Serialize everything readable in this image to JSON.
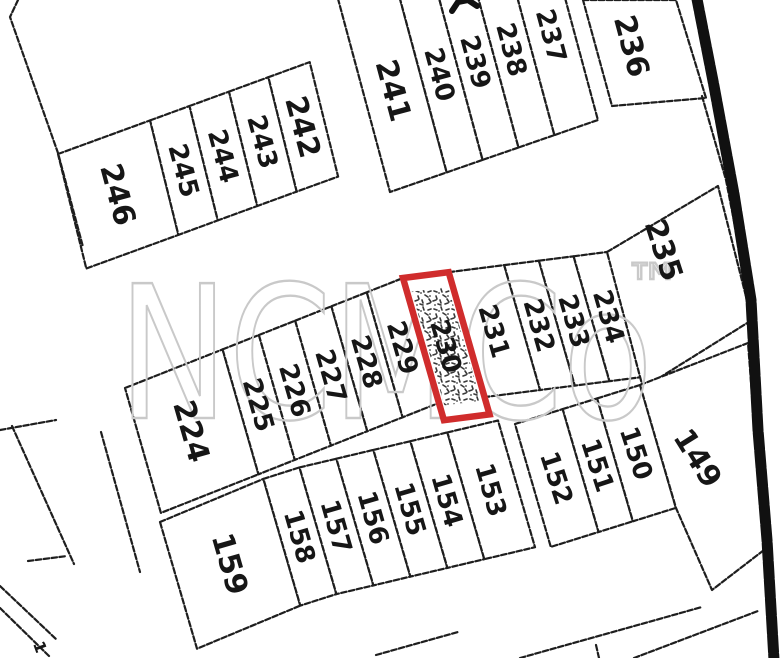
{
  "map": {
    "background": "#ffffff",
    "line_color": "#1e1e1e",
    "highlight_color": "#d02c2c",
    "stipple_color": "#3a3a3a",
    "watermark": {
      "text": "NCMCo",
      "tm": "™",
      "color": "#c9c9c9",
      "x": 118,
      "y": 418,
      "size": 185,
      "textLength": 535,
      "tmX": 624,
      "tmY": 305,
      "tmSize": 58
    },
    "rows": [
      {
        "name": "block-246-242",
        "baseline": "top",
        "polyline": [
          [
            58,
            154
          ],
          [
            310,
            62
          ]
        ],
        "lean": [
          0.24,
          0.97
        ],
        "depth": 118,
        "textAngle": 75,
        "lots": [
          {
            "label": "246",
            "w": 98,
            "big": true
          },
          {
            "label": "245",
            "w": 42
          },
          {
            "label": "244",
            "w": 42
          },
          {
            "label": "243",
            "w": 42
          },
          {
            "label": "242",
            "w": 44,
            "big": true
          }
        ]
      },
      {
        "name": "block-241-237",
        "baseline": "bottom",
        "polyline": [
          [
            390,
            192
          ],
          [
            598,
            120
          ]
        ],
        "lean": [
          0.26,
          0.966
        ],
        "depth": 230,
        "labelOffset": -95,
        "textAngle": 75,
        "lots": [
          {
            "label": "241",
            "w": 60,
            "big": true
          },
          {
            "label": "240",
            "w": 38
          },
          {
            "label": "239",
            "w": 38
          },
          {
            "label": "238",
            "w": 38
          },
          {
            "label": "237",
            "w": 46
          }
        ]
      },
      {
        "name": "block-224-234",
        "baseline": "top",
        "polyline": [
          [
            125,
            388
          ],
          [
            403,
            278
          ],
          [
            607,
            252
          ]
        ],
        "lean": [
          0.276,
          0.961
        ],
        "depth": 130,
        "textAngle": 74,
        "lots": [
          {
            "label": "224",
            "w": 105,
            "big": true
          },
          {
            "label": "225",
            "w": 39
          },
          {
            "label": "226",
            "w": 39
          },
          {
            "label": "227",
            "w": 39
          },
          {
            "label": "228",
            "w": 38
          },
          {
            "label": "229",
            "w": 39
          },
          {
            "label": "230",
            "w": 46,
            "d": 148,
            "highlight": true
          },
          {
            "label": "231",
            "w": 56
          },
          {
            "label": "232",
            "w": 35
          },
          {
            "label": "233",
            "w": 35
          },
          {
            "label": "234",
            "w": 35
          }
        ]
      },
      {
        "name": "block-159-153",
        "baseline": "top",
        "polyline": [
          [
            160,
            522
          ],
          [
            280,
            472
          ],
          [
            500,
            420
          ]
        ],
        "lean": [
          0.28,
          0.96
        ],
        "depth": 132,
        "textAngle": 74,
        "lots": [
          {
            "label": "159",
            "w": 112,
            "big": true
          },
          {
            "label": "158",
            "w": 38
          },
          {
            "label": "157",
            "w": 38
          },
          {
            "label": "156",
            "w": 38
          },
          {
            "label": "155",
            "w": 38
          },
          {
            "label": "154",
            "w": 38
          },
          {
            "label": "153",
            "w": 52
          }
        ]
      },
      {
        "name": "block-152-150",
        "baseline": "top",
        "polyline": [
          [
            515,
            424
          ],
          [
            640,
            385
          ]
        ],
        "lean": [
          0.28,
          0.96
        ],
        "depth": 128,
        "textAngle": 72,
        "lots": [
          {
            "label": "152",
            "w": 50
          },
          {
            "label": "151",
            "w": 36
          },
          {
            "label": "150",
            "w": 45
          }
        ]
      }
    ],
    "explicit_lots": [
      {
        "label": "236",
        "quad": [
          [
            583,
            0
          ],
          [
            676,
            0
          ],
          [
            706,
            98
          ],
          [
            612,
            106
          ]
        ],
        "labelPos": [
          632,
          46
        ],
        "angle": 75,
        "big": true
      },
      {
        "label": "235",
        "quad": [
          [
            607,
            252
          ],
          [
            718,
            186
          ],
          [
            752,
            320
          ],
          [
            643,
            388
          ]
        ],
        "labelPos": [
          664,
          250
        ],
        "angle": 72,
        "big": true
      },
      {
        "label": "149",
        "quad": [
          [
            640,
            385
          ],
          [
            748,
            343
          ],
          [
            764,
            550
          ],
          [
            712,
            590
          ],
          [
            676,
            508
          ]
        ],
        "labelPos": [
          698,
          458
        ],
        "angle": 58,
        "big": true
      }
    ],
    "extra_labels": [
      {
        "text": "1",
        "pos": [
          40,
          647
        ],
        "angle": 70,
        "size": 16
      }
    ],
    "extra_lines": [
      {
        "name": "outer-boundary-left",
        "pts": [
          [
            18,
            0
          ],
          [
            10,
            17
          ],
          [
            58,
            153
          ],
          [
            83,
            247
          ]
        ]
      },
      {
        "name": "left-scrap-1",
        "pts": [
          [
            0,
            430
          ],
          [
            56,
            420
          ]
        ]
      },
      {
        "name": "left-scrap-2",
        "pts": [
          [
            12,
            426
          ],
          [
            74,
            564
          ]
        ]
      },
      {
        "name": "left-scrap-3",
        "pts": [
          [
            28,
            561
          ],
          [
            67,
            556
          ]
        ]
      },
      {
        "name": "left-road-edge",
        "pts": [
          [
            101,
            432
          ],
          [
            140,
            572
          ]
        ]
      },
      {
        "name": "bottom-left-line-1",
        "pts": [
          [
            0,
            586
          ],
          [
            57,
            640
          ]
        ]
      },
      {
        "name": "bottom-left-line-2",
        "pts": [
          [
            0,
            608
          ],
          [
            49,
            656
          ]
        ]
      },
      {
        "name": "bottom-block-line-1",
        "pts": [
          [
            376,
            655
          ],
          [
            458,
            632
          ]
        ]
      },
      {
        "name": "bottom-block-line-2",
        "pts": [
          [
            520,
            658
          ],
          [
            702,
            607
          ]
        ]
      },
      {
        "name": "bottom-block-tick",
        "pts": [
          [
            596,
            645
          ],
          [
            599,
            658
          ]
        ]
      },
      {
        "name": "bottom-block-line-3",
        "pts": [
          [
            634,
            658
          ],
          [
            758,
            611
          ]
        ]
      },
      {
        "name": "road-inner-line",
        "pts": [
          [
            702,
            96
          ],
          [
            726,
            180
          ],
          [
            747,
            288
          ],
          [
            754,
            420
          ]
        ]
      }
    ],
    "road_thick": {
      "pts": [
        [
          696,
          -6
        ],
        [
          714,
          86
        ],
        [
          734,
          194
        ],
        [
          751,
          300
        ],
        [
          758,
          430
        ],
        [
          767,
          540
        ],
        [
          774,
          660
        ]
      ],
      "width": 11
    },
    "top_edge_mark": {
      "pts": [
        [
          452,
          11
        ],
        [
          458,
          2
        ],
        [
          468,
          0
        ],
        [
          477,
          6
        ]
      ],
      "width": 6
    }
  }
}
